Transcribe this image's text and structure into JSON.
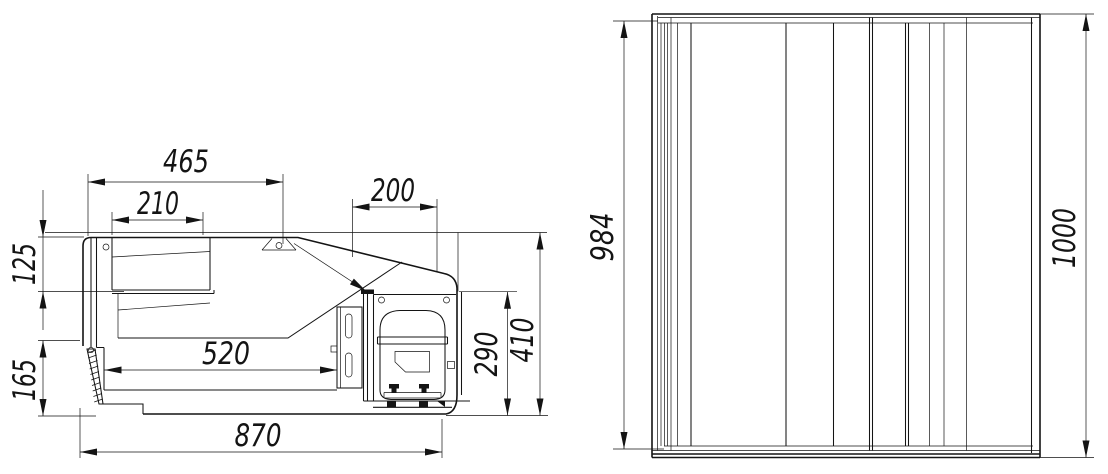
{
  "drawing": {
    "background": "#ffffff",
    "line_color": "#141414",
    "views": {
      "side": {
        "label": "side-section-view",
        "dims": {
          "w_top": "465",
          "w_canopy": "210",
          "w_machine": "200",
          "h_canopy": "125",
          "h_base": "165",
          "w_well": "520",
          "h_machine": "290",
          "h_overall": "410",
          "w_overall": "870"
        }
      },
      "front": {
        "label": "front-view",
        "dims": {
          "h_body": "984",
          "h_overall": "1000"
        }
      }
    }
  }
}
